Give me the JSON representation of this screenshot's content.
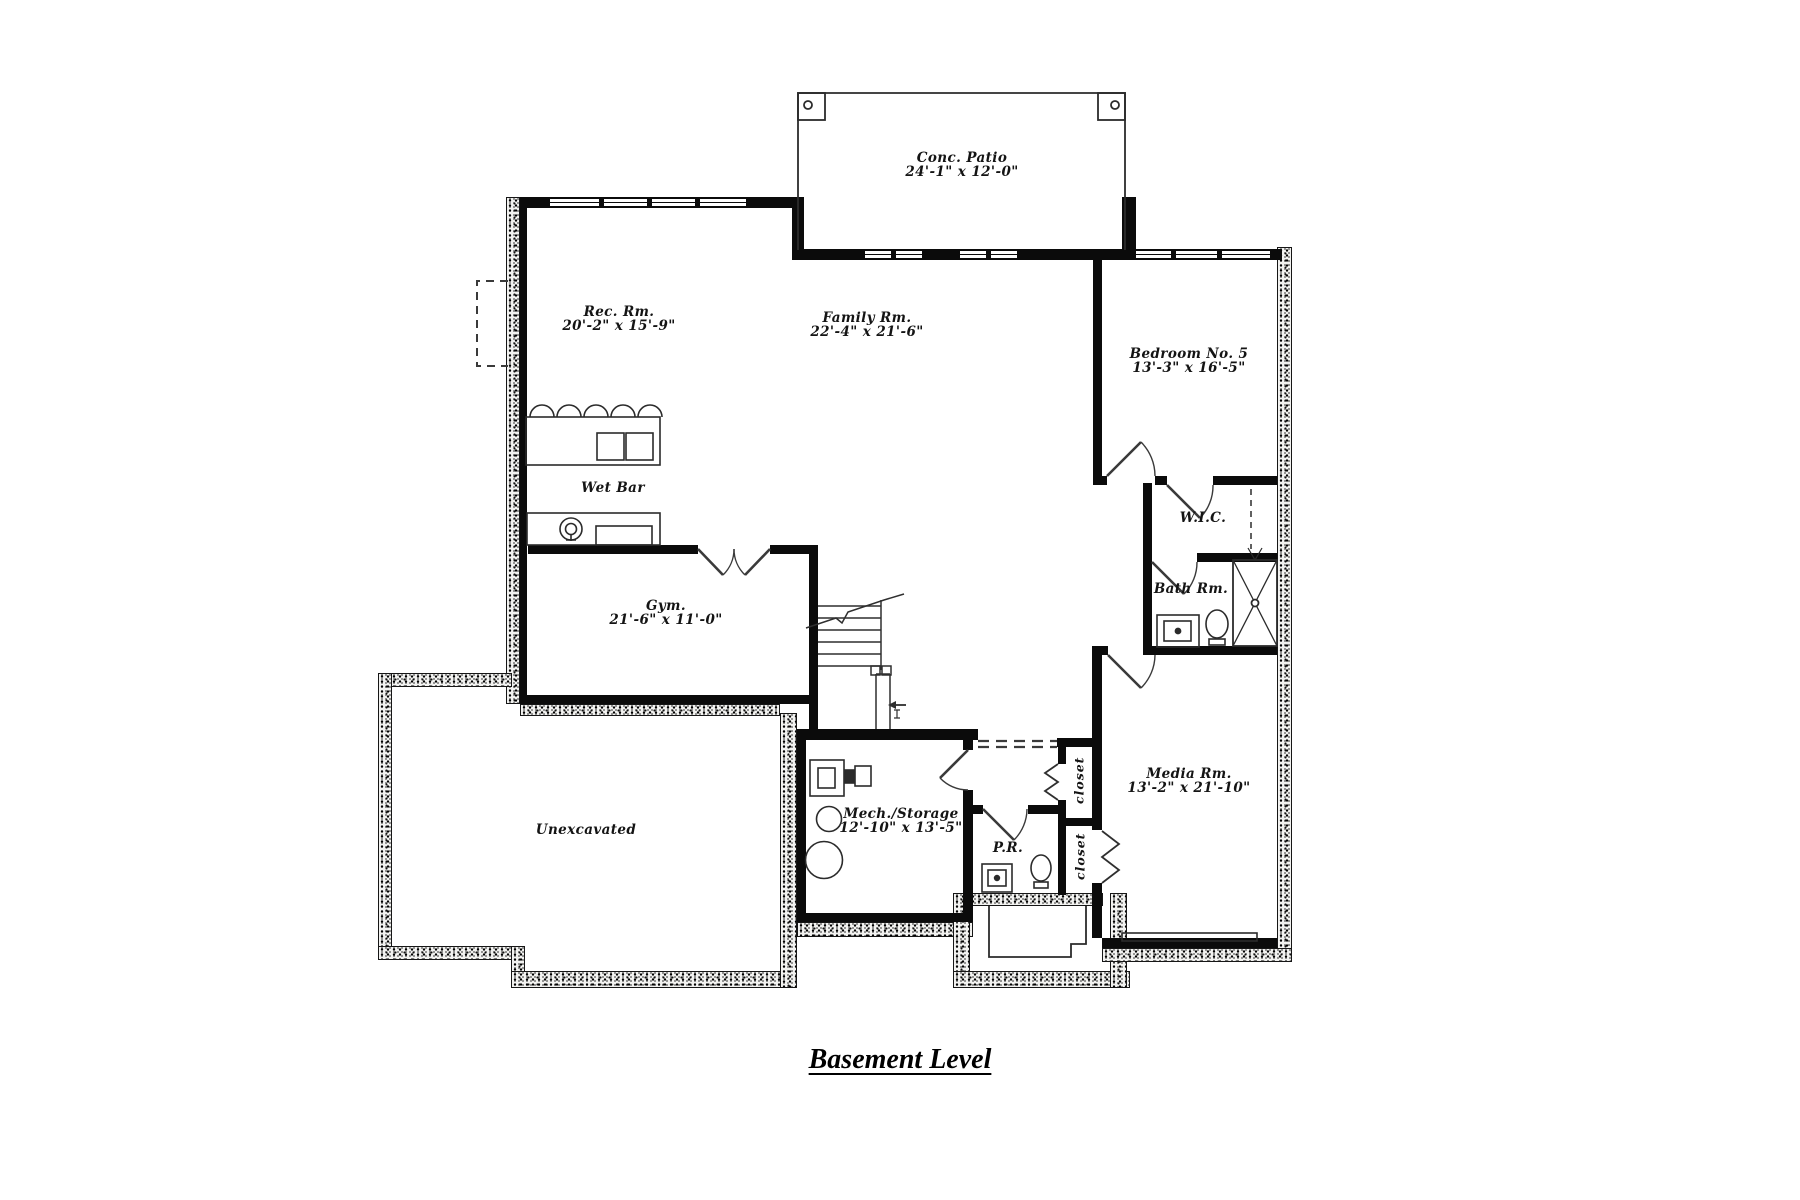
{
  "title": {
    "text": "Basement Level"
  },
  "rooms": {
    "patio": {
      "name": "Conc. Patio",
      "dims": "24'-1\" x 12'-0\""
    },
    "rec": {
      "name": "Rec. Rm.",
      "dims": "20'-2\" x 15'-9\""
    },
    "family": {
      "name": "Family Rm.",
      "dims": "22'-4\" x 21'-6\""
    },
    "bedroom5": {
      "name": "Bedroom No. 5",
      "dims": "13'-3\" x 16'-5\""
    },
    "wet_bar": {
      "name": "Wet Bar"
    },
    "gym": {
      "name": "Gym.",
      "dims": "21'-6\" x 11'-0\""
    },
    "wic": {
      "name": "W.I.C."
    },
    "bath": {
      "name": "Bath Rm."
    },
    "media": {
      "name": "Media Rm.",
      "dims": "13'-2\" x 21'-10\""
    },
    "mech": {
      "name": "Mech./Storage",
      "dims": "12'-10\" x 13'-5\""
    },
    "pr": {
      "name": "P.R."
    },
    "unexcavated": {
      "name": "Unexcavated"
    },
    "closet_upper": {
      "name": "closet"
    },
    "closet_lower": {
      "name": "closet"
    }
  },
  "colors": {
    "wall": "#0b0b0b",
    "line": "#2b2b2b",
    "background": "#ffffff"
  }
}
